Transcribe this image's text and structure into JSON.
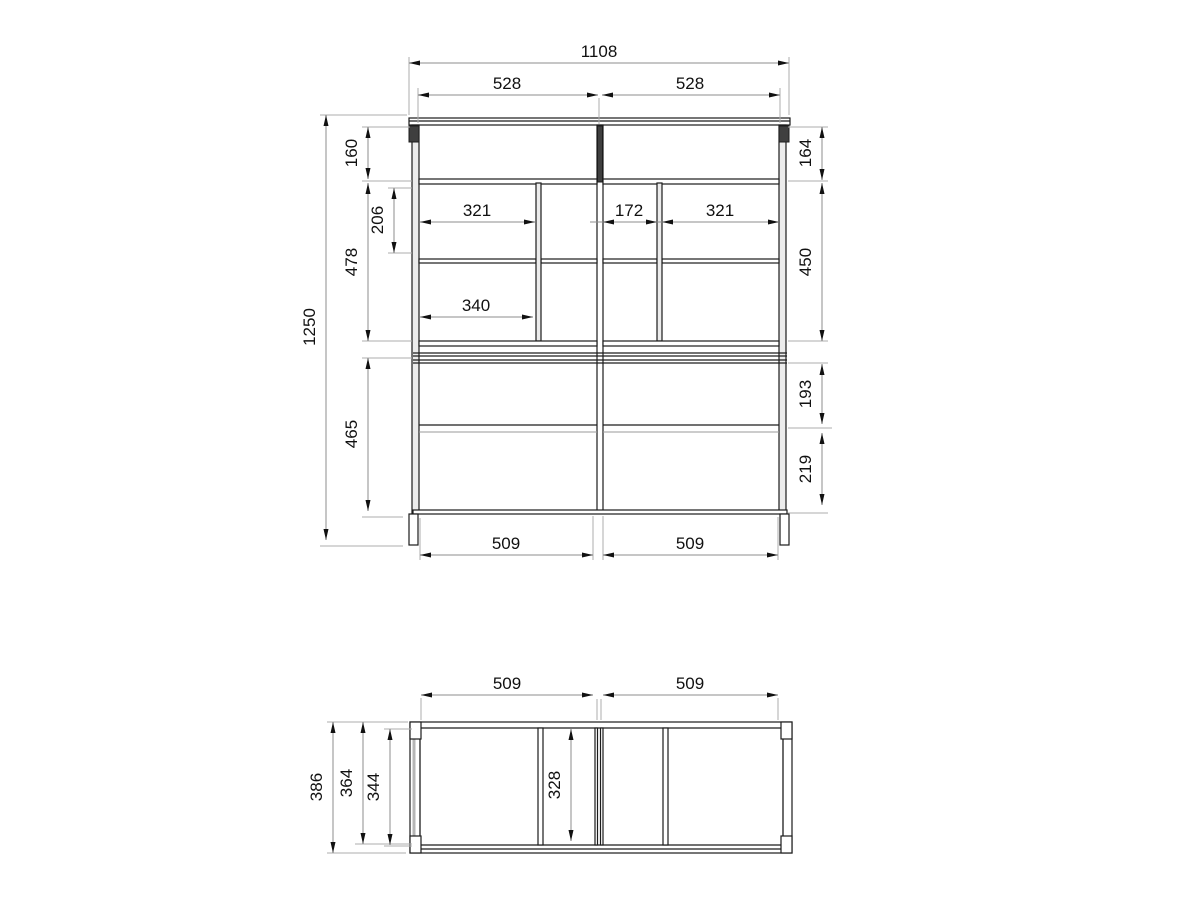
{
  "drawing": {
    "type": "furniture technical drawing, front view and top view with dimensions",
    "line_color": "#1c1c1c",
    "dimension_line_color": "#8c8c8c"
  },
  "front_view": {
    "overall_width": "1108",
    "left_half_width": "528",
    "right_half_width": "528",
    "overall_height": "1250",
    "top_section_height_left": "160",
    "top_section_height_right": "164",
    "upper_compartment_height": "206",
    "middle_section_height_left": "478",
    "middle_section_height_right": "450",
    "lower_section_height": "465",
    "drawer_height_upper": "193",
    "drawer_height_lower": "219",
    "left_compartment_width": "321",
    "center_compartment_width": "172",
    "right_compartment_width": "321",
    "shelf_width": "340",
    "base_width_left": "509",
    "base_width_right": "509"
  },
  "top_view": {
    "half_width_left": "509",
    "half_width_right": "509",
    "overall_depth": "386",
    "inner_depth_1": "364",
    "inner_depth_2": "344",
    "compartment_depth": "328"
  }
}
